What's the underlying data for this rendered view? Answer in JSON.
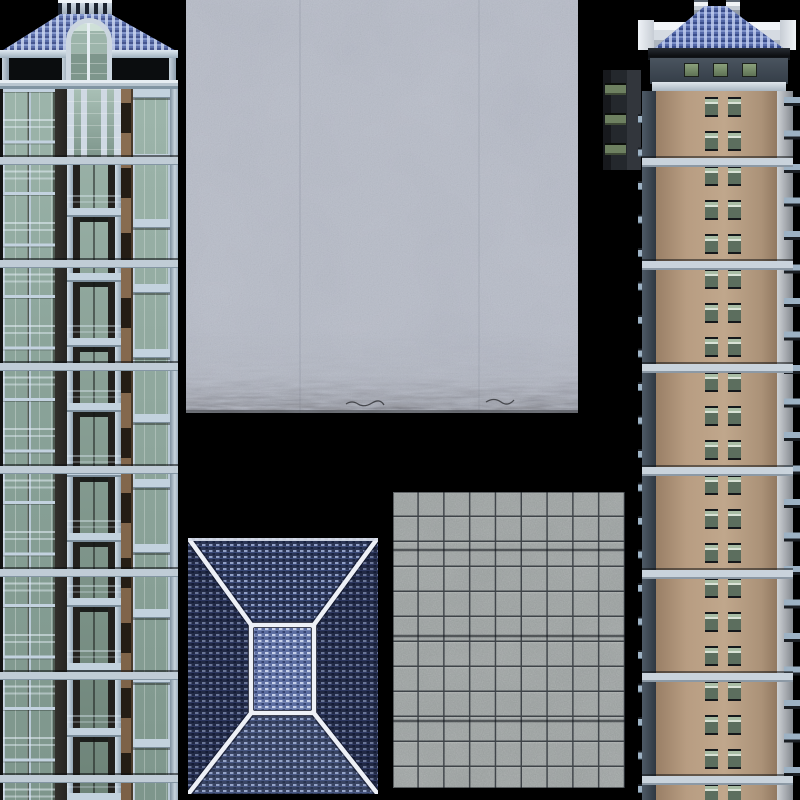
{
  "atlas": {
    "title": "3D building model texture atlas",
    "background_color": "#000000",
    "textures": [
      {
        "id": "left-tower-facade",
        "kind": "apartment tower facade, full height strip on left edge",
        "features": "blue shingle hip roof with balustrade crown, arched glass atrium, open loggia, glass balcony columns, tan accent strip, horizontal steel ledges",
        "colors": {
          "roof": "#5d70ab",
          "roof_speckle": "#c8d4ee",
          "wall": "#23211e",
          "glass": "#8ea99f",
          "frames_rails": "#c0ccd6",
          "tan_accent": "#7c6147"
        }
      },
      {
        "id": "stucco-wall",
        "kind": "weathered stucco / concrete wall square, top middle",
        "features": "mottled light blue-gray plaster with dark grime fringe along bottom edge",
        "colors": {
          "base": "#b7bcc8",
          "blotch": "#8e93a2",
          "grime": "#43454c"
        }
      },
      {
        "id": "hip-roof-top-view",
        "kind": "hip roof shingle texture seen from above, bottom middle-left",
        "features": "four shingle slopes, white ridge lines from corners to central flat rectangle, lighter central deck",
        "colors": {
          "shingles_dark": "#2b3554",
          "shingles_light": "#5c6da0",
          "speckle": "#91a0c6",
          "ridge_lines": "#edf0f6"
        }
      },
      {
        "id": "paving-tiles",
        "kind": "square concrete paving tile grid, bottom center",
        "grid": {
          "columns": 9,
          "rows": 12
        },
        "colors": {
          "base": "#9aa09f",
          "joints": "#262b31"
        }
      },
      {
        "id": "louver-panel",
        "kind": "small dark wall panel with three green window slits, upper middle-right",
        "slit_count": 3,
        "colors": {
          "panel": "#24282d",
          "glass": "#6d8060"
        }
      },
      {
        "id": "right-tower-facade",
        "kind": "apartment tower facade, full height strip on right edge",
        "features": "blue shingle hip roof with twin chimneys, white parapet, slate attic band with three green windows, tan wall with paired recessed windows, side balcony nubs, horizontal ledges",
        "colors": {
          "roof": "#5468a8",
          "parapet": "#f2f5f8",
          "attic_band": "#3f4852",
          "wall": "#b89d82",
          "window_glass": "#5c6e5e",
          "ledges": "#c9d3dc"
        }
      }
    ]
  }
}
